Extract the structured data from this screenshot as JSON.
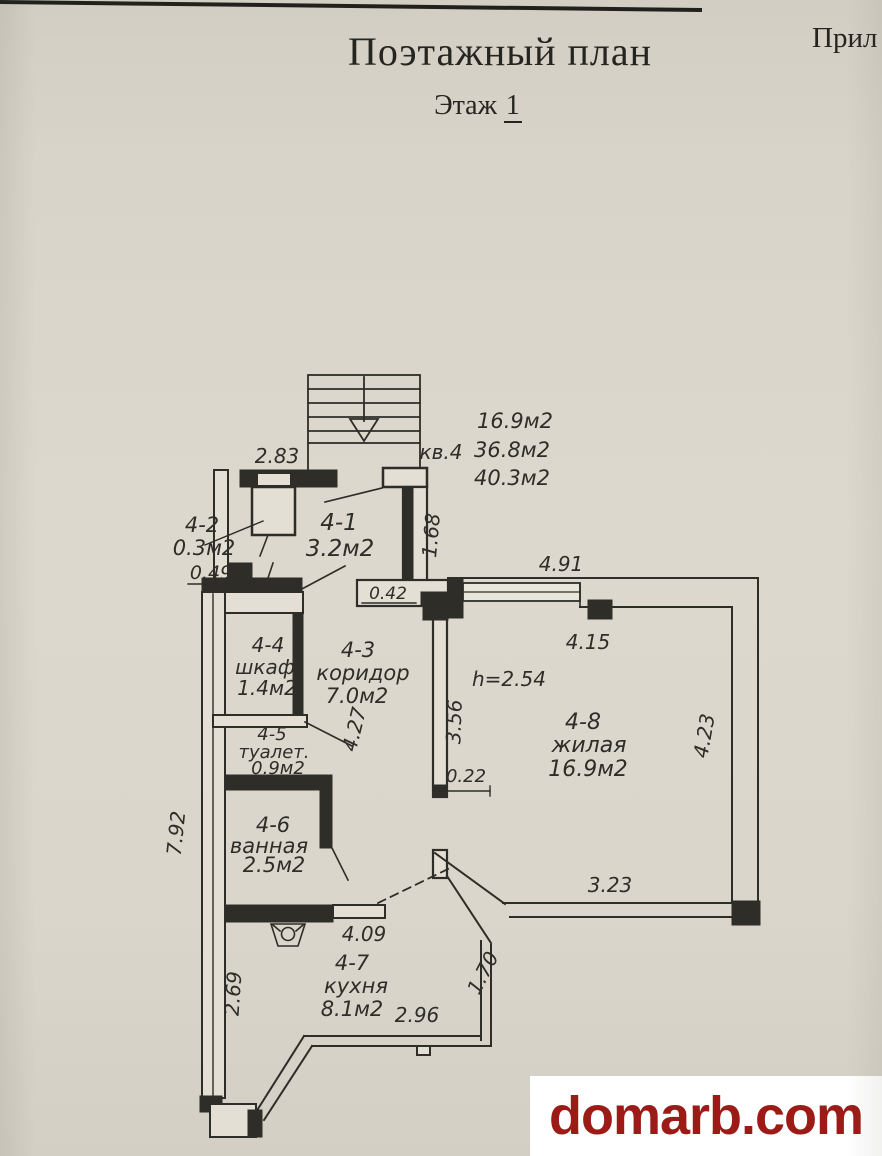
{
  "document": {
    "title": "Поэтажный план",
    "floor_label": "Этаж",
    "floor_value": "1",
    "corner_text": "Прил"
  },
  "plan": {
    "apartment_label": "кв.4",
    "area_summary": [
      "16.9м2",
      "36.8м2",
      "40.3м2"
    ],
    "ceiling_height": "h=2.54",
    "rooms": [
      {
        "id": "4-1",
        "name": "",
        "area": "3.2м2"
      },
      {
        "id": "4-2",
        "name": "",
        "area": "0.3м2"
      },
      {
        "id": "4-3",
        "name": "коридор",
        "area": "7.0м2"
      },
      {
        "id": "4-4",
        "name": "шкаф",
        "area": "1.4м2"
      },
      {
        "id": "4-5",
        "name": "туалет.",
        "area": "0.9м2"
      },
      {
        "id": "4-6",
        "name": "ванная",
        "area": "2.5м2"
      },
      {
        "id": "4-7",
        "name": "кухня",
        "area": "8.1м2"
      },
      {
        "id": "4-8",
        "name": "жилая",
        "area": "16.9м2"
      }
    ],
    "dimensions": {
      "top_width": "2.83",
      "closet_width": "0.49",
      "hall_depth": "1.68",
      "pier": "0.42",
      "living_top": "4.91",
      "living_width": "4.15",
      "living_side": "4.23",
      "corridor_depth": "4.27",
      "corridor_right": "3.56",
      "door_gap": "0.22",
      "left_side": "7.92",
      "living_bottom": "3.23",
      "kitchen_top": "4.09",
      "kitchen_diag": "1.70",
      "kitchen_left": "2.69",
      "kitchen_bottom": "2.96"
    }
  },
  "watermark": {
    "text": "domarb.com"
  },
  "colors": {
    "paper": "#d8d4ca",
    "ink": "#2e2d28",
    "watermark_red": "#9c1b17",
    "watermark_bg": "#ffffff"
  }
}
